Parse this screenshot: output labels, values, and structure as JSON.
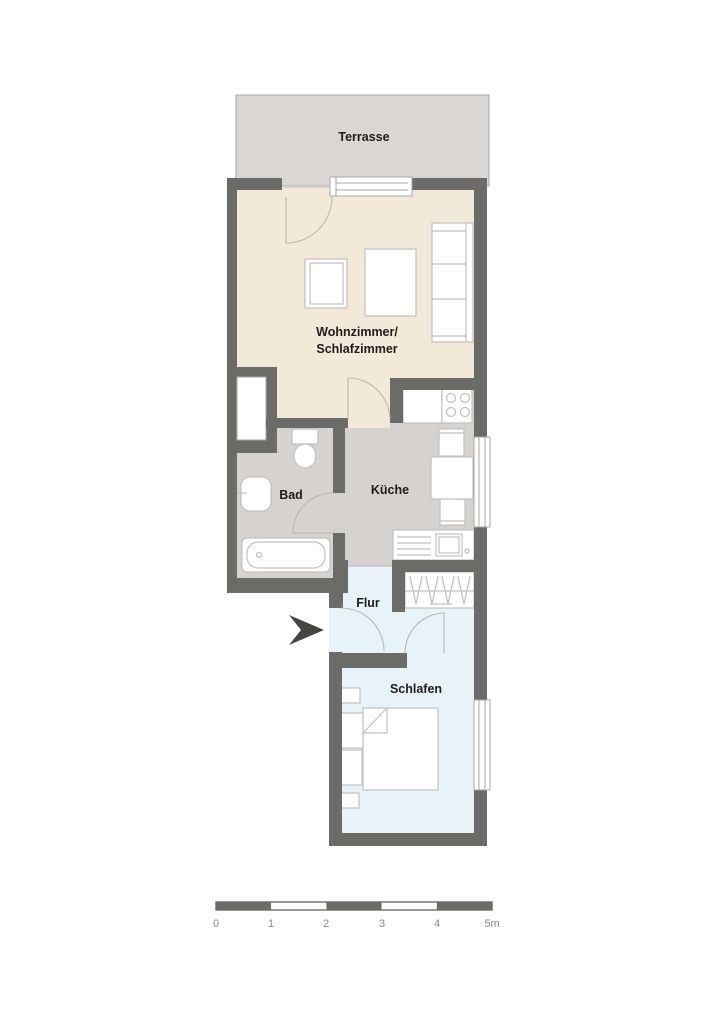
{
  "plan": {
    "type": "apartment-floor-plan",
    "rooms": [
      {
        "id": "terrasse",
        "label": "Terrasse"
      },
      {
        "id": "wohnzimmer",
        "label_line1": "Wohnzimmer/",
        "label_line2": "Schlafzimmer"
      },
      {
        "id": "bad",
        "label": "Bad"
      },
      {
        "id": "kueche",
        "label": "Küche"
      },
      {
        "id": "flur",
        "label": "Flur"
      },
      {
        "id": "schlafen",
        "label": "Schlafen"
      }
    ]
  },
  "scale_bar": {
    "segments": 5,
    "unit_labels": [
      "0",
      "1",
      "2",
      "3",
      "4",
      "5m"
    ]
  },
  "colors": {
    "wall": "#6b6b67",
    "terrace": "#d9d6d4",
    "living": "#f2e9d8",
    "wet": "#d6d2d0",
    "sleep": "#e7f2f9",
    "furnitureStroke": "#c3c1bf",
    "windowStroke": "#aaa8a6",
    "floorLine": "#b9b7b5",
    "text": "#1d1d1b",
    "scaleText": "#8b8987",
    "arrow": "#454542"
  }
}
